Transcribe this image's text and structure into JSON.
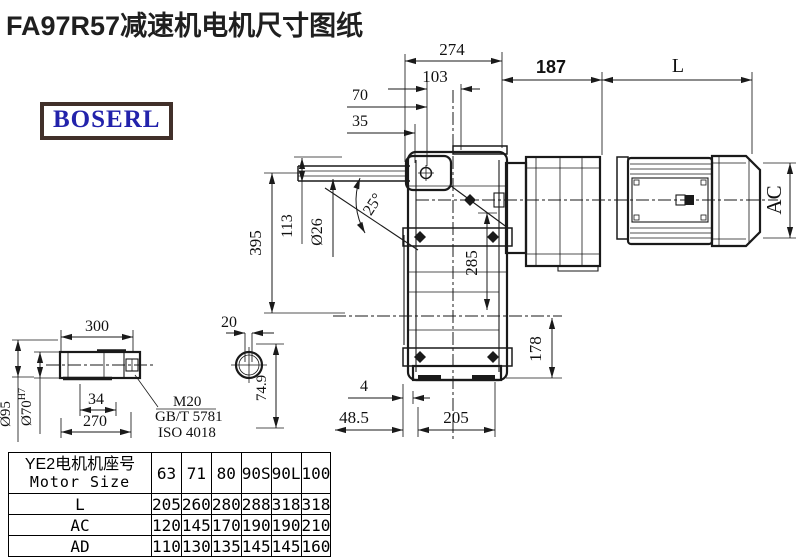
{
  "title": "FA97R57减速机电机尺寸图纸",
  "logo": "BOSERL",
  "colors": {
    "line": "#1a1a1a",
    "logo_text": "#2222ab",
    "logo_border": "#41302a"
  },
  "dims": {
    "d274": "274",
    "d103": "103",
    "d70": "70",
    "d35": "35",
    "d187": "187",
    "dL": "L",
    "dAC": "AC",
    "d395": "395",
    "d113": "113",
    "d26": "Ø26",
    "d25": "25°",
    "d285": "285",
    "d178": "178",
    "d4": "4",
    "d485": "48.5",
    "d205": "205",
    "d300": "300",
    "d20": "20",
    "d95": "Ø95",
    "d70b": "Ø70",
    "d70sup": "H7",
    "d34": "34",
    "d270": "270",
    "d749": "74.9",
    "m20": "M20",
    "gbt": "GB/T 5781",
    "iso": "ISO 4018"
  },
  "table": {
    "header_cn": "YE2电机机座号",
    "header_en": "Motor Size",
    "sizes": [
      "63",
      "71",
      "80",
      "90S",
      "90L",
      "100"
    ],
    "rows": [
      {
        "label": "L",
        "values": [
          "205",
          "260",
          "280",
          "288",
          "318",
          "318"
        ]
      },
      {
        "label": "AC",
        "values": [
          "120",
          "145",
          "170",
          "190",
          "190",
          "210"
        ]
      },
      {
        "label": "AD",
        "values": [
          "110",
          "130",
          "135",
          "145",
          "145",
          "160"
        ]
      }
    ]
  }
}
